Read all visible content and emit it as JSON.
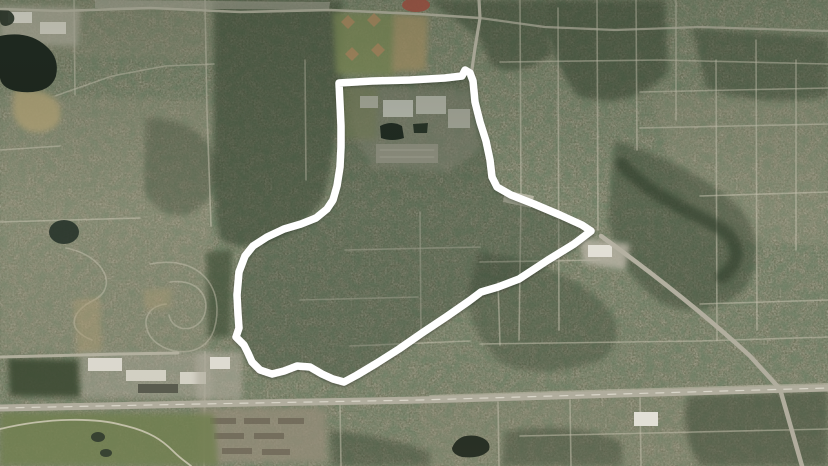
{
  "meta": {
    "description": "Aerial satellite view of a suburban area with a thick white boundary outline drawn around a district; major highway along the bottom, lake at top-left, school campus and sports fields at the top of the outlined district.",
    "view": "satellite",
    "width": 828,
    "height": 466
  },
  "map": {
    "palette": {
      "base": "#74775f",
      "forest": "#2f3e2a",
      "residential": "#a29c86",
      "street": "#c6c2b0",
      "road": "#b6b2a3",
      "water": "#1f2a21",
      "sand": "#b3a478",
      "park": "#71814f",
      "roof_light": "#e9e7de",
      "track_red": "#a85043",
      "boundary": "#ffffff"
    },
    "boundary": {
      "color": "#ffffff",
      "width": 7.5,
      "interior_fill": "rgba(42,54,34,0.20)",
      "points": "339,83 372,81 410,80 445,78 462,76 465,70 470,73 473,81 475,102 480,122 486,141 490,160 492,177 497,187 511,195 534,204 560,215 582,225 591,231 574,244 548,260 519,279 498,287 481,292 469,301 446,317 422,333 399,349 377,363 357,375 344,382 333,379 322,374 310,367 297,366 284,371 272,374 260,370 252,362 248,353 244,345 236,337 239,328 238,314 237,295 239,272 245,256 253,246 267,237 284,229 301,224 316,218 327,209 333,200 337,186 340,167 341,147 341,126 340,104"
    },
    "regions": [
      {
        "n": "residential-west",
        "d": "M0,95 L212,100 L210,350 L0,353 Z",
        "f": "#a29c86",
        "o": 0.28,
        "blur": true
      },
      {
        "n": "residential-north-strip",
        "d": "M0,0 L214,0 L212,60 L0,55 Z",
        "f": "#9a947f",
        "o": 0.25,
        "blur": true
      },
      {
        "n": "residential-northeast",
        "d": "M655,95 L828,102 L828,245 L700,238 Q668,165 655,95 Z",
        "f": "#a29c86",
        "o": 0.22,
        "blur": true
      },
      {
        "n": "residential-southeast",
        "d": "M420,396 L828,388 L828,466 L420,466 Z",
        "f": "#9a947f",
        "o": 0.18,
        "blur": true
      },
      {
        "n": "forest-west-band",
        "d": "M214,0 L342,0 L342,80 Q336,152 324,198 Q308,226 266,242 Q234,252 220,238 Q212,208 214,148 Z",
        "f": "#2f3e2a",
        "o": 0.5,
        "blur": true
      },
      {
        "n": "forest-top-center",
        "d": "M428,0 L545,0 L552,55 Q520,78 492,66 L478,36 Z",
        "f": "#2f3e2a",
        "o": 0.45,
        "blur": true
      },
      {
        "n": "forest-northeast-1",
        "d": "M545,0 L665,0 L668,72 Q632,112 578,96 Q548,60 545,0 Z",
        "f": "#2f3e2a",
        "o": 0.5,
        "blur": true
      },
      {
        "n": "forest-northeast-2",
        "d": "M692,28 L828,38 L828,96 Q762,108 706,88 Z",
        "f": "#2f3e2a",
        "o": 0.4,
        "blur": true
      },
      {
        "n": "forest-east-mid",
        "d": "M615,140 Q700,168 742,210 Q772,252 742,292 Q700,322 660,302 Q618,272 608,220 Z",
        "f": "#2f3e2a",
        "o": 0.4,
        "blur": true
      },
      {
        "n": "forest-east-lower",
        "d": "M478,252 Q560,262 602,302 Q632,332 602,360 Q540,382 500,362 Q468,332 468,292 Z",
        "f": "#2f3e2a",
        "o": 0.32,
        "blur": true
      },
      {
        "n": "forest-se-below-highway",
        "d": "M688,396 L828,390 L828,466 L700,466 Q678,430 688,396 Z",
        "f": "#2f3e2a",
        "o": 0.45,
        "blur": true
      },
      {
        "n": "forest-south-center",
        "d": "M505,432 Q570,420 622,442 L622,466 L502,466 Z",
        "f": "#2f3e2a",
        "o": 0.4,
        "blur": true
      },
      {
        "n": "forest-left-strip",
        "d": "M206,252 L232,250 L230,336 L208,338 Z",
        "f": "#3e4d35",
        "o": 0.65,
        "blur": true
      },
      {
        "n": "forest-left-mid",
        "d": "M146,118 Q200,118 216,158 Q222,198 190,214 Q158,220 144,190 Z",
        "f": "#2f3e2a",
        "o": 0.3,
        "blur": true
      },
      {
        "n": "forest-south-of-apartments",
        "d": "M330,430 Q390,436 430,452 L430,466 L332,466 Z",
        "f": "#2f3e2a",
        "o": 0.4,
        "blur": true
      }
    ],
    "streets": [
      {
        "d": "M520,0 L521,200 L519,340"
      },
      {
        "d": "M558,8 L559,330"
      },
      {
        "d": "M597,0 L598,230"
      },
      {
        "d": "M636,0 L637,150"
      },
      {
        "d": "M676,0 L676,120"
      },
      {
        "d": "M716,60 L717,340"
      },
      {
        "d": "M756,40 L757,330"
      },
      {
        "d": "M796,60 L796,250"
      },
      {
        "d": "M500,62 L660,60 L828,64"
      },
      {
        "d": "M640,92 L828,88"
      },
      {
        "d": "M640,128 L828,124"
      },
      {
        "d": "M700,196 L828,192"
      },
      {
        "d": "M700,304 L828,300"
      },
      {
        "d": "M480,344 L700,341 L828,337"
      },
      {
        "d": "M480,262 L600,260"
      },
      {
        "d": "M345,250 L480,247"
      },
      {
        "d": "M420,212 L421,335"
      },
      {
        "d": "M300,300 L418,297"
      },
      {
        "d": "M350,346 L470,341"
      },
      {
        "d": "M498,282 L500,345"
      },
      {
        "d": "M205,0 L207,112 L211,226"
      },
      {
        "d": "M74,0 L75,95"
      },
      {
        "d": "M55,96 L112,76 L165,66 L214,64"
      },
      {
        "d": "M0,150 L60,146"
      },
      {
        "d": "M0,222 L140,218"
      },
      {
        "d": "M305,60 L306,180",
        "o": 0.45
      },
      {
        "d": "M150,264 C202,254 226,290 214,330 C204,360 164,356 150,336 C140,318 150,306 166,304",
        "o": 0.5
      },
      {
        "d": "M170,282 C200,278 212,300 203,318 C194,334 172,331 169,315",
        "o": 0.5
      },
      {
        "d": "M66,248 C106,256 118,288 94,300 C70,312 66,330 92,340",
        "o": 0.5
      },
      {
        "d": "M498,402 L499,466"
      },
      {
        "d": "M570,400 L571,466"
      },
      {
        "d": "M640,398 L641,466"
      },
      {
        "d": "M520,436 L828,429"
      },
      {
        "d": "M340,404 L341,466"
      },
      {
        "d": "M205,352 L204,466",
        "o": 0.5,
        "w": 2
      },
      {
        "d": "M430,396 L620,390 L828,384",
        "o": 0.6,
        "w": 2
      }
    ],
    "patches": [
      {
        "n": "campus-grounds",
        "d": "M350,86 L472,90 L480,150 L448,172 L372,168 L352,128 Z",
        "f": "#a5a191",
        "o": 0.5,
        "blur": true
      },
      {
        "n": "campus-field",
        "d": "M338,86 L378,88 L376,140 L340,138 Z",
        "f": "#8f9468",
        "o": 0.6,
        "blur": true
      },
      {
        "n": "sports-green",
        "d": "M333,12 L396,14 L394,76 L336,74 Z",
        "f": "#7e8b59",
        "o": 0.85,
        "blur": true
      },
      {
        "n": "tan-field-top",
        "d": "M394,14 L428,16 L426,70 L392,72 Z",
        "f": "#a89468",
        "o": 0.8,
        "blur": true
      },
      {
        "n": "running-track",
        "cx": 416,
        "cy": 5,
        "rx": 14,
        "ry": 7,
        "f": "#a85043",
        "o": 0.9
      },
      {
        "n": "ball-diamond-1",
        "d": "M341,22 l7,-7 l7,7 l-7,7 Z",
        "f": "#b08a62",
        "o": 0.85
      },
      {
        "n": "ball-diamond-2",
        "d": "M367,20 l7,-7 l7,7 l-7,7 Z",
        "f": "#b08a62",
        "o": 0.85
      },
      {
        "n": "ball-diamond-3",
        "d": "M345,54 l7,-7 l7,7 l-7,7 Z",
        "f": "#b08a62",
        "o": 0.85
      },
      {
        "n": "ball-diamond-4",
        "d": "M371,50 l7,-7 l7,7 l-7,7 Z",
        "f": "#b08a62",
        "o": 0.85
      },
      {
        "n": "top-parking-strip",
        "d": "M95,0 L330,2 L329,10 L95,8 Z",
        "f": "#b1ada0",
        "o": 0.6
      },
      {
        "n": "commercial-northwest",
        "d": "M0,6 L80,8 L78,46 L0,44 Z",
        "f": "#b7b3a4",
        "o": 0.7,
        "blur": true
      },
      {
        "n": "roof-nw-1",
        "d": "M8,12 h24 v11 h-24 Z",
        "f": "#e2dfd5"
      },
      {
        "n": "roof-nw-2",
        "d": "M40,22 h26 v12 h-26 Z",
        "f": "#d9d6ca"
      },
      {
        "n": "sand-flat-below-lake",
        "d": "M14,90 Q52,86 60,108 Q64,128 42,132 Q18,134 13,112 Z",
        "f": "#b3a478",
        "o": 0.85,
        "blur": true
      },
      {
        "n": "sand-wash-1",
        "d": "M73,300 L100,297 L102,352 L78,355 Z",
        "f": "#ac9c74",
        "o": 0.5,
        "blur": true
      },
      {
        "n": "sand-wash-2",
        "d": "M143,290 L172,288 L170,308 L145,310 Z",
        "f": "#ac9c74",
        "o": 0.45,
        "blur": true
      },
      {
        "n": "campus-building-1",
        "d": "M383,100 h30 v17 h-30 Z",
        "f": "#e9e7de"
      },
      {
        "n": "campus-building-2",
        "d": "M416,96 h30 v18 h-30 Z",
        "f": "#dedbd0"
      },
      {
        "n": "campus-building-3",
        "d": "M448,109 h22 v19 h-22 Z",
        "f": "#cfccc0"
      },
      {
        "n": "campus-building-4",
        "d": "M360,96 h18 v12 h-18 Z",
        "f": "#d8d5c9",
        "o": 0.9
      },
      {
        "n": "campus-parking",
        "d": "M376,144 h62 v19 h-62 Z",
        "f": "#b2aea0",
        "o": 0.9
      },
      {
        "n": "campus-parking-row",
        "d": "M380,150 h54",
        "w": 0.8,
        "f": "#ded9cc",
        "o": 0.7
      },
      {
        "n": "campus-parking-row",
        "d": "M380,157 h54",
        "w": 0.8,
        "f": "#ded9cc",
        "o": 0.7
      },
      {
        "n": "commercial-east-lot",
        "d": "M580,238 L630,244 L625,270 L583,263 Z",
        "f": "#b7b3a4",
        "o": 0.85,
        "blur": true
      },
      {
        "n": "commercial-east-roof",
        "d": "M588,245 h24 v12 h-24 Z",
        "f": "#e5e2d9"
      },
      {
        "n": "strip-mall-inner-se",
        "d": "M505,190 L534,196 L531,208 L503,202 Z",
        "f": "#c6c2b2",
        "o": 0.8
      },
      {
        "n": "highway-commercial-lot",
        "d": "M80,352 h132 v46 h-132 Z",
        "f": "#ada99b",
        "o": 0.5,
        "blur": true
      },
      {
        "n": "highway-roof-1",
        "d": "M88,358 h34 v13 h-34 Z",
        "f": "#e3e0d6"
      },
      {
        "n": "highway-roof-2",
        "d": "M126,370 h40 v11 h-40 Z",
        "f": "#dad7cb"
      },
      {
        "n": "highway-roof-dark",
        "d": "M138,384 h40 v9 h-40 Z",
        "f": "#585a4e"
      },
      {
        "n": "highway-roof-3",
        "d": "M180,372 h26 v12 h-26 Z",
        "f": "#dfdcd1",
        "o": 0.95
      },
      {
        "n": "junction-lot",
        "d": "M196,352 h46 v48 h-46 Z",
        "f": "#b2aea0",
        "o": 0.6,
        "blur": true
      },
      {
        "n": "junction-roof",
        "d": "M210,357 h20 v12 h-20 Z",
        "f": "#e6e3da"
      },
      {
        "n": "apartments-block",
        "d": "M198,408 h128 v54 h-128 Z",
        "f": "#978f7b",
        "o": 0.75,
        "blur": true
      },
      {
        "n": "apartment-row",
        "d": "M210,418 h26 v6 h-26 Z",
        "f": "#6d6556",
        "o": 0.8
      },
      {
        "n": "apartment-row",
        "d": "M244,418 h26 v6 h-26 Z",
        "f": "#6d6556",
        "o": 0.8
      },
      {
        "n": "apartment-row",
        "d": "M278,418 h26 v6 h-26 Z",
        "f": "#6d6556",
        "o": 0.8
      },
      {
        "n": "apartment-row",
        "d": "M214,433 h30 v6 h-30 Z",
        "f": "#6d6556",
        "o": 0.8
      },
      {
        "n": "apartment-row",
        "d": "M254,433 h30 v6 h-30 Z",
        "f": "#6d6556",
        "o": 0.8
      },
      {
        "n": "apartment-row",
        "d": "M222,448 h30 v6 h-30 Z",
        "f": "#6d6556",
        "o": 0.8
      },
      {
        "n": "apartment-row",
        "d": "M262,449 h28 v6 h-28 Z",
        "f": "#6d6556",
        "o": 0.8
      },
      {
        "n": "white-building-east",
        "d": "M634,412 h24 v14 h-24 Z",
        "f": "#eceae2"
      },
      {
        "n": "golf-course",
        "d": "M0,412 L214,414 L218,466 L0,466 Z",
        "f": "#71814f",
        "o": 0.85,
        "blur": true
      },
      {
        "n": "dark-field",
        "d": "M8,358 L78,360 L80,397 L10,396 Z",
        "f": "#3a4832",
        "o": 0.9,
        "blur": true
      },
      {
        "n": "creek-corridor",
        "d": "M622,164 C650,196 688,210 716,226 C742,240 742,262 722,277",
        "f": "#2e3c29",
        "w": 13,
        "o": 0.6,
        "blur": true
      }
    ],
    "water": [
      {
        "n": "lake-main",
        "d": "M0,36 Q28,30 46,46 Q60,58 56,76 Q50,94 22,92 Q2,90 0,78 Z",
        "f": "#1b241d"
      },
      {
        "n": "lake-inlet",
        "d": "M0,10 Q10,8 14,16 Q16,24 6,26 Q0,26 0,20 Z",
        "f": "#232d24",
        "o": 0.9
      },
      {
        "n": "pond-left",
        "cx": 64,
        "cy": 232,
        "rx": 15,
        "ry": 12,
        "f": "#27332a",
        "o": 0.9
      },
      {
        "n": "pond-bottom-center",
        "d": "M452,448 Q458,433 477,436 Q492,440 489,450 Q482,459 462,457 Q452,454 452,448 Z",
        "f": "#20291f"
      },
      {
        "n": "golf-pond-1",
        "cx": 98,
        "cy": 437,
        "rx": 7,
        "ry": 5,
        "f": "#2a3529",
        "o": 0.9
      },
      {
        "n": "golf-pond-2",
        "cx": 106,
        "cy": 453,
        "rx": 6,
        "ry": 4,
        "f": "#2a3529",
        "o": 0.9
      },
      {
        "n": "campus-pond-1",
        "d": "M380,126 Q392,120 402,126 L404,138 Q392,142 381,138 Z",
        "f": "#1d2620"
      },
      {
        "n": "campus-pond-2",
        "d": "M413,124 L428,123 L427,133 L414,133 Z",
        "f": "#222b22",
        "o": 0.95
      }
    ],
    "roads": [
      {
        "n": "highway-main",
        "d": "M0,408 L200,404 L420,400 L620,394 L828,388",
        "w": 7,
        "f": "#b6b2a3"
      },
      {
        "n": "highway-centerline",
        "d": "M0,408 L200,404 L420,400 L620,394 L828,388",
        "w": 1.2,
        "f": "#ece9dd",
        "da": "8 8",
        "o": 0.8
      },
      {
        "n": "road-diagonal-southeast",
        "d": "M601,236 C648,270 702,312 750,356 L780,389 L802,466",
        "w": 4.5,
        "f": "#b6b2a3"
      },
      {
        "n": "road-north-junction",
        "d": "M479,0 L480,18 L475,48 L471,76",
        "w": 3.2,
        "f": "#bdb9a9"
      },
      {
        "n": "road-top-west",
        "d": "M480,18 L420,14 L330,10 L240,12 L150,8 L60,11 L0,9",
        "w": 2.6,
        "f": "#bdb9a9",
        "o": 0.9
      },
      {
        "n": "road-top-east",
        "d": "M480,18 L545,27 L615,30 L700,27 L828,31",
        "w": 2.2,
        "f": "#bdb9a9",
        "o": 0.75
      },
      {
        "n": "road-west-horizontal",
        "d": "M0,357 L120,354 L178,353",
        "w": 3,
        "f": "#bdb9a9",
        "o": 0.9
      },
      {
        "n": "golf-cart-path",
        "d": "M0,429 C50,417 96,418 122,425 C150,431 163,441 173,451 C181,459 186,462 191,466",
        "w": 1.8,
        "f": "#d8d4bf",
        "o": 0.85
      }
    ]
  }
}
